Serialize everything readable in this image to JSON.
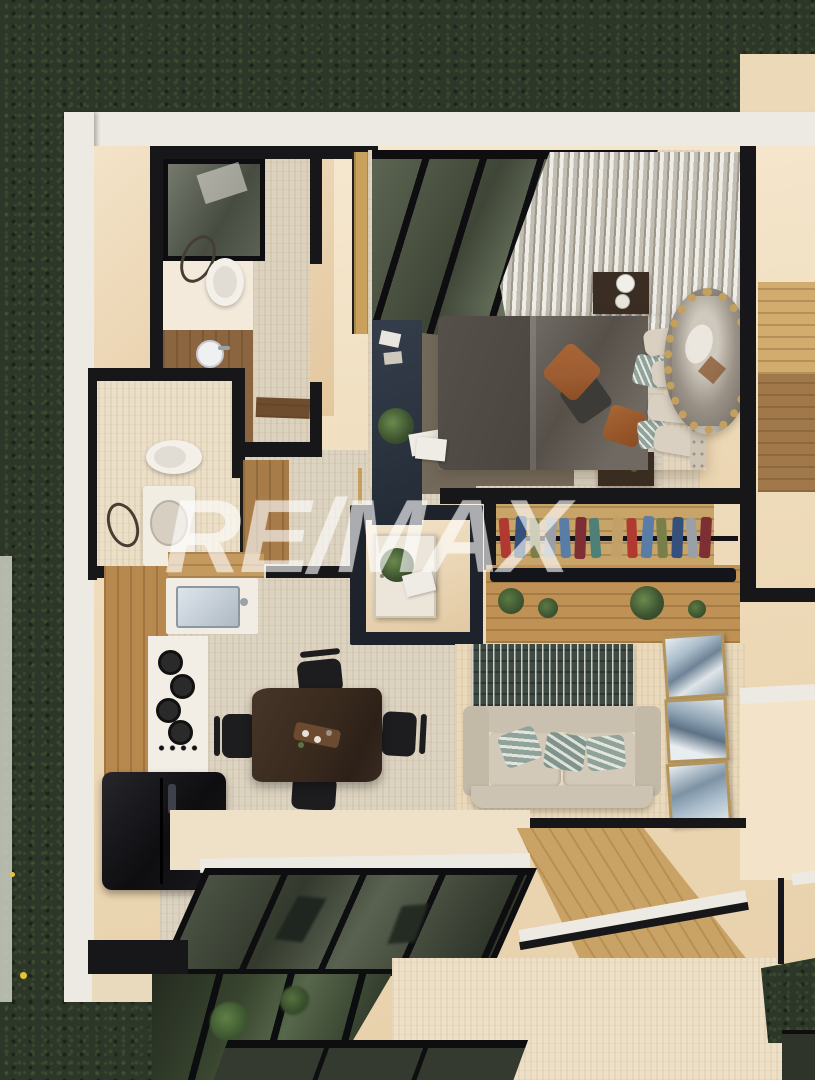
{
  "watermark": {
    "text": "RE/MAX",
    "color": "#ffffff",
    "opacity": 0.5
  },
  "palette": {
    "grass_base": "#2d3729",
    "grass_dark": "#1e261b",
    "flower_yellow": "#e5c438",
    "path_light": "#cdd0c2",
    "outer_wall_white": "#eceae2",
    "wall_beige_light": "#f6e9d2",
    "wall_beige": "#eedbb9",
    "wall_beige_shadow": "#dfc39a",
    "floor_travertine": "#dcd3c0",
    "floor_beige": "#eee0c6",
    "floor_warm": "#ead9bb",
    "wall_black": "#17171a",
    "frame_black": "#0e0e11",
    "glass_dark": "#3f4637",
    "glass_mid": "#5c6452",
    "glass_light": "#77806b",
    "wood_light": "#cda76b",
    "wood_mid": "#b8894f",
    "wood_dark": "#7e5c37",
    "wood_deck": "#c9a265",
    "wood_counter": "#6e4d2e",
    "white_fixture": "#f3f0ea",
    "steel_sink": "#c3ced8",
    "appliance_black": "#141417",
    "navy_furniture": "#2b333f",
    "duvet_gray": "#6e6862",
    "duvet_dark": "#4b4540",
    "bed_rug": "#746a5c",
    "headboard": "#cfc5b4",
    "pillow_beige": "#d9d0c1",
    "pillow_rust": "#9c5c31",
    "pillow_dark": "#3c3b38",
    "pillow_teal": "#8fa39b",
    "curtain_light": "#efede7",
    "curtain_shadow": "#9d968a",
    "mirror_gold": "#c4a05f",
    "mirror_glass": "#8f877b",
    "rug_teal": "#3e4b45",
    "rug_stripe": "#e7e4da",
    "sofa_beige": "#ccc3b2",
    "sofa_shadow": "#b4aa97",
    "art_gold": "#b2945c",
    "table_wood": "#38291d",
    "chair_black": "#1d1d20",
    "plant_green": "#3f5531",
    "plant_dark": "#2a3a21",
    "cloth_red": "#b03a30",
    "cloth_blue": "#5a7da8",
    "cloth_olive": "#7a7f4a",
    "cloth_gray": "#9aa0a6",
    "cloth_navy": "#35507a",
    "cloth_maroon": "#7e2f33",
    "cloth_teal": "#4e8078",
    "cloth_tan": "#c2a06a"
  },
  "scene": {
    "view": "top-down 3d architectural render",
    "setting": "apartment unit surrounded by lawn, adjacent unit at right, lower level visible at bottom",
    "rooms": [
      {
        "name": "bathroom-1",
        "furniture": [
          "walk-in shower",
          "toilet",
          "wood vanity with round sink",
          "towel ring"
        ]
      },
      {
        "name": "bedroom",
        "furniture": [
          "glass interior wall",
          "curtain",
          "double bed with rust pillows",
          "two nightstands",
          "table lamp",
          "round rattan mirror",
          "navy dresser",
          "plants",
          "magazines",
          "rugs"
        ]
      },
      {
        "name": "walk-in-closet",
        "furniture": [
          "clothes rail with hanging clothes",
          "wood console with plants"
        ]
      },
      {
        "name": "entry-vestibule",
        "furniture": [
          "white entry door"
        ]
      },
      {
        "name": "bathroom-2",
        "furniture": [
          "toilet",
          "vanity with round basin",
          "towel ring",
          "wood door"
        ]
      },
      {
        "name": "kitchen",
        "furniture": [
          "wood cabinets",
          "steel sink",
          "gas cooktop",
          "black refrigerator"
        ]
      },
      {
        "name": "dining",
        "furniture": [
          "live-edge wood table",
          "four black chairs",
          "centerpiece tray"
        ]
      },
      {
        "name": "living",
        "furniture": [
          "striped teal rug",
          "beige sofa with teal pillows",
          "three framed artworks",
          "wood deck walkway"
        ]
      },
      {
        "name": "terrace",
        "furniture": [
          "black-framed sliding glass doors",
          "lower-level windows with plants",
          "patio floor"
        ]
      }
    ]
  }
}
